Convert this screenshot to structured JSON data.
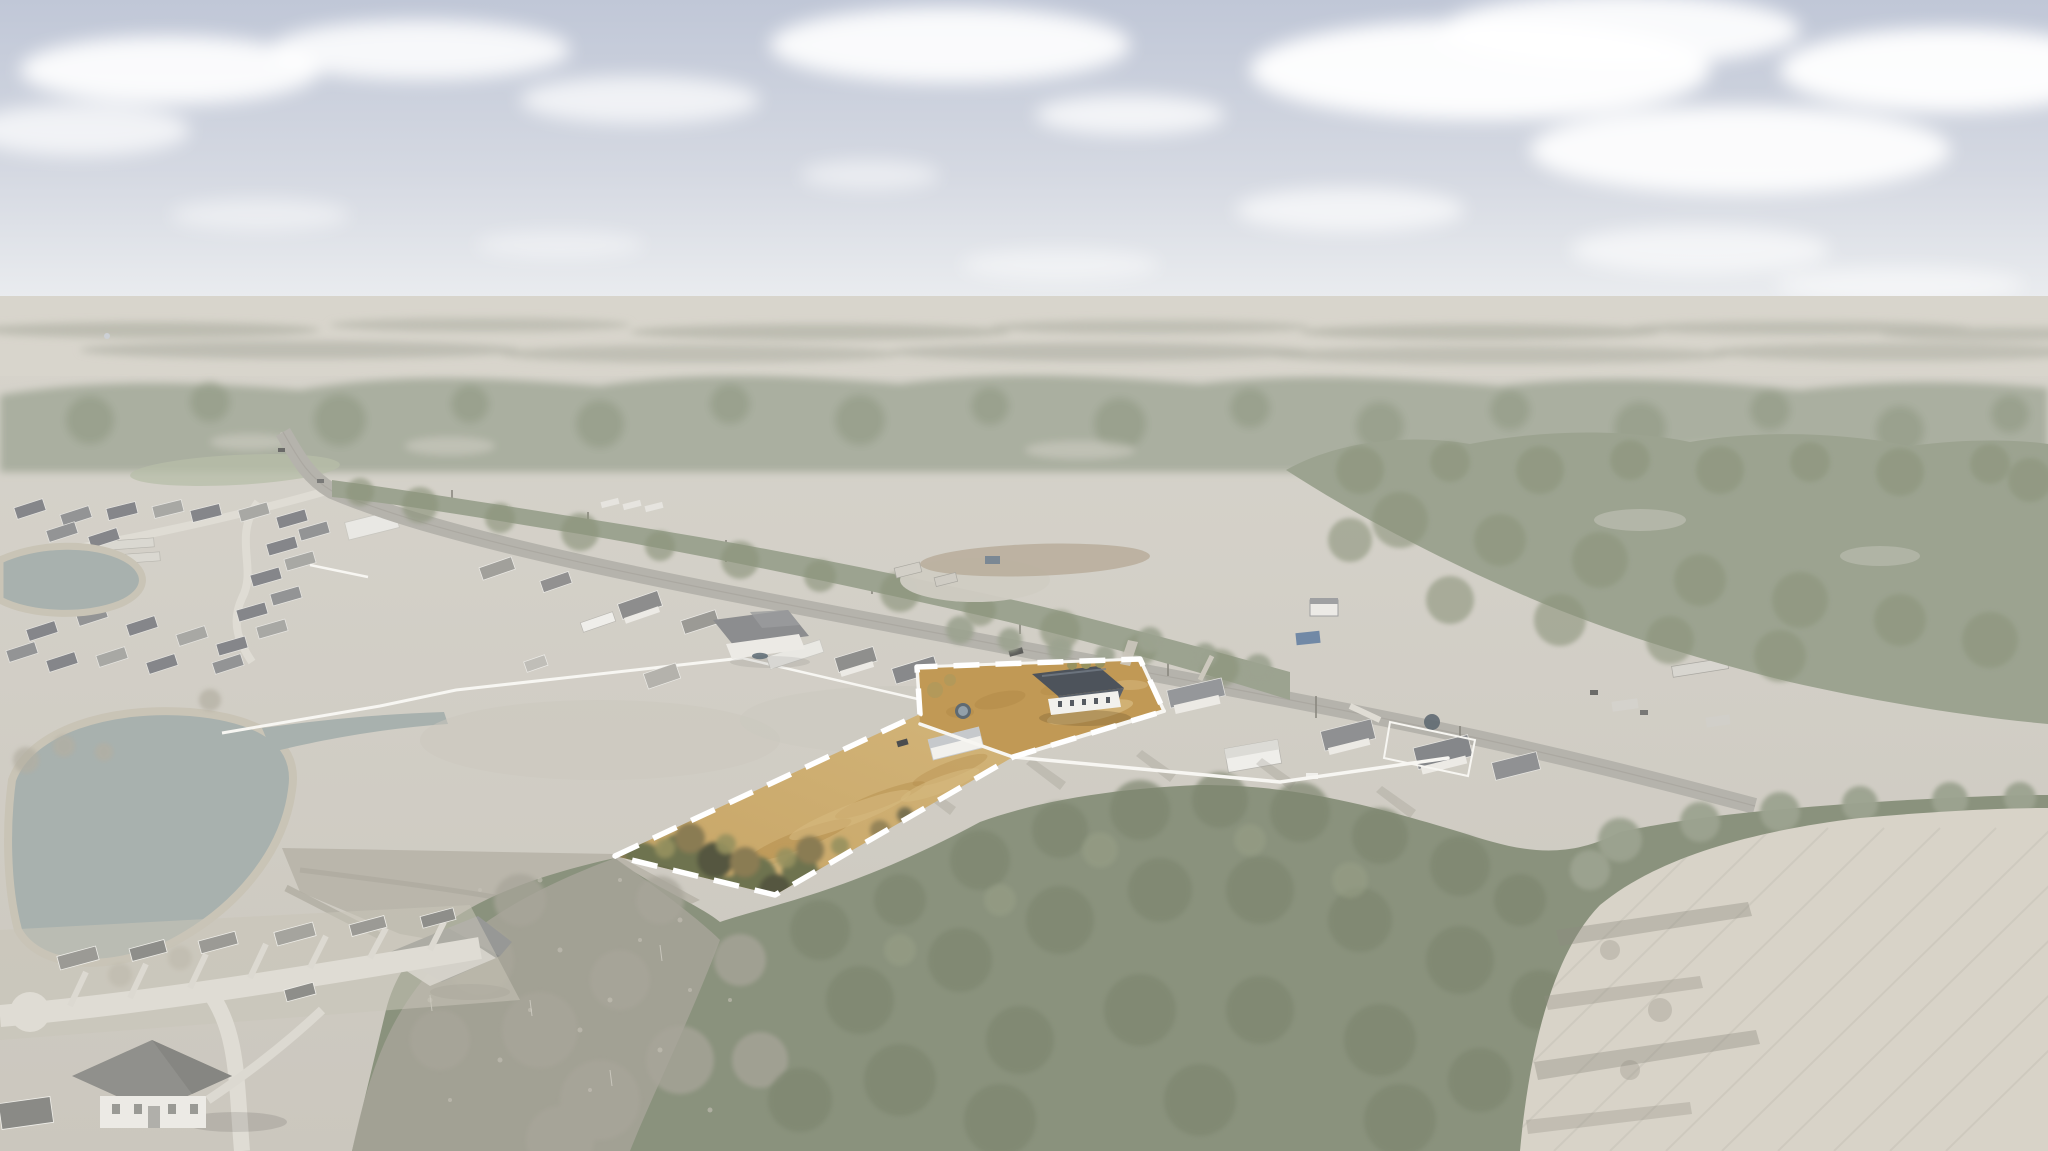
{
  "scene": {
    "description": "Oblique aerial drone photograph of a rural highway corridor. The whole photo is desaturated and washed out except one long narrow vacant land parcel highlighted in warm tan with a white dashed boundary; the highlighted lot holds tan field grass, a cluster of trees at its west tip, and at its northeast end a small white house with a dark slate roof, a white shed, a round pool and bright white fencing. Faded surroundings include a hazy cloudy sky, pine and bare-tree forest, a curving highway with utility poles, rows of roadside houses and sheds, two ponds beside housing subdivisions, mobile homes in clearings, a dense bottom forest and a plowed field with tree shadows at lower right."
  },
  "colors": {
    "sky_top": "#c0c7d7",
    "sky_mid": "#d5d9e2",
    "sky_bottom": "#edeff1",
    "cloud": "#ffffff",
    "distant_field": "#d8d5cc",
    "distant_trees": "#b6b6ab",
    "forest_band": "#a8ad9d",
    "forest_dark": "#949c87",
    "forest_light_gap": "#d0cec5",
    "forest_right": "#9ca390",
    "forest_right_dark": "#8c947c",
    "ground_top": "#d7d4cc",
    "ground_bottom": "#cbc7be",
    "pond": "#a8b1ae",
    "pond_edge": "#c9c4b6",
    "road": "#b5b3ac",
    "street": "#dfdcd4",
    "driveway": "#dcd9d1",
    "fence": "#f7f6f2",
    "house_body": "#eceae5",
    "roof_gray": "#9b9a95",
    "roof_dark": "#85868a",
    "barn_white": "#efeeea",
    "forest_bottom": "#8a927d",
    "forest_bottom_dark": "#7e8670",
    "bare": "#a8a59a",
    "bare_light": "#c6c2b7",
    "field_br": "#d8d3c8",
    "furrow": "#cbc6bb",
    "shadow": "#8e8b81",
    "parcel_tan": "#c7a566",
    "parcel_tan_light": "#d6b97f",
    "parcel_dirt": "#c19955",
    "parcel_dirt_dark": "#b28a47",
    "tree_green": "#6e7350",
    "tree_dark": "#555741",
    "tree_brown": "#8a7b52",
    "tree_olive": "#97925f",
    "p_house_roof": "#4d535b",
    "p_house_body": "#f2f1ed",
    "shed_roof": "#c6c9cc",
    "pool": "#5f6a72",
    "boundary": "#ffffff",
    "blue_carport": "#7189a6",
    "pasture_green": "#b7bda8"
  }
}
